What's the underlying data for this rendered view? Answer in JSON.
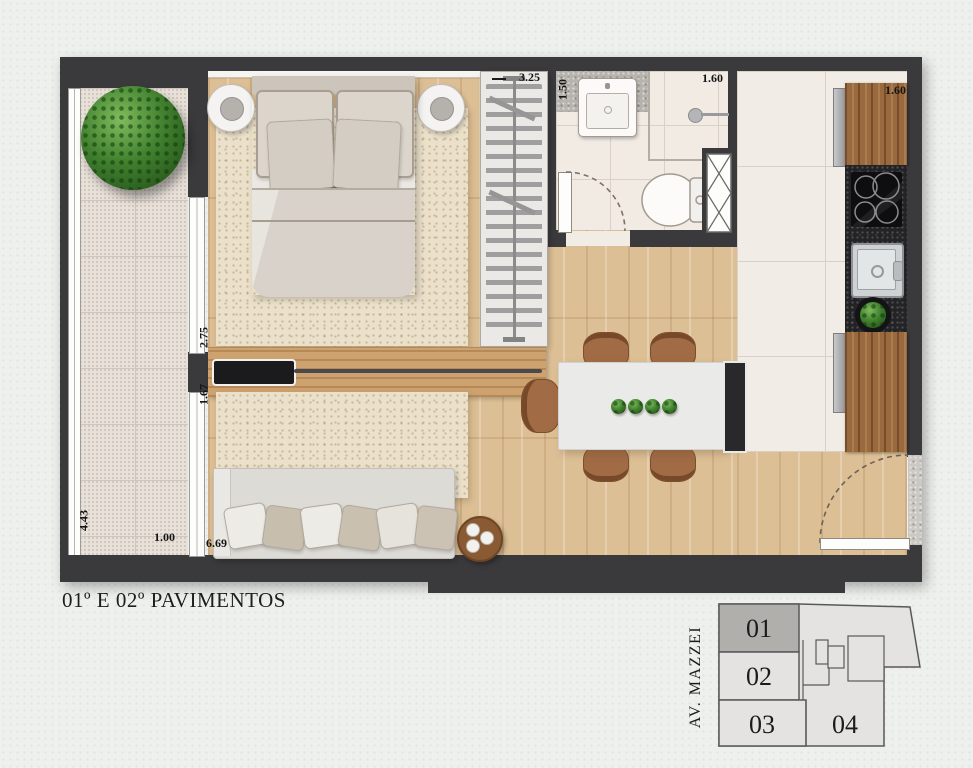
{
  "title": "01º E 02º PAVIMENTOS",
  "plan": {
    "dimensions": {
      "wardrobe": "3.25",
      "bathroom": "1.50",
      "shower": "1.60",
      "kitchen": "1.60",
      "bedroom_window": "2.75",
      "living_window": "1.67",
      "balcony_length": "4.43",
      "balcony_width": "1.00",
      "living_length": "6.69"
    }
  },
  "keyplan": {
    "street": "AV. MAZZEI",
    "units": [
      {
        "label": "01",
        "highlighted": true
      },
      {
        "label": "02",
        "highlighted": false
      },
      {
        "label": "03",
        "highlighted": false
      },
      {
        "label": "04",
        "highlighted": false
      }
    ]
  },
  "colors": {
    "wall": "#3a3a3c",
    "wood_floor": "#dcbf95",
    "balcony_tile": "#e8e1da",
    "bath_tile": "#f1ebe4",
    "granite": "#232326",
    "cabinet_wood": "#9a6a3e",
    "plant_green": "#3e7b2d",
    "keyplan_highlight": "#b1afab"
  }
}
